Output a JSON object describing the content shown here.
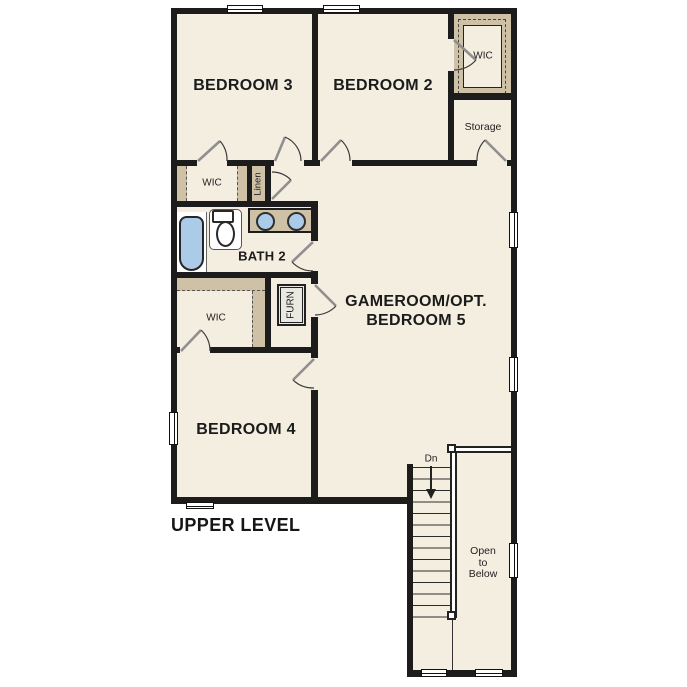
{
  "plan": {
    "title": "UPPER LEVEL",
    "labels": {
      "bedroom3": "BEDROOM 3",
      "bedroom2": "BEDROOM 2",
      "bedroom4": "BEDROOM 4",
      "gameroom_line1": "GAMEROOM/OPT.",
      "gameroom_line2": "BEDROOM 5",
      "bath2": "BATH 2",
      "wic_top_right": "WIC",
      "wic_upper": "WIC",
      "wic_lower": "WIC",
      "storage": "Storage",
      "linen": "Linen",
      "furnace": "FURN",
      "down": "Dn",
      "open_below_1": "Open",
      "open_below_2": "to",
      "open_below_3": "Below"
    },
    "colors": {
      "floor": "#f4eee1",
      "wall": "#1c1c1c",
      "shelf": "#cec1a6",
      "fixture_blue": "#abcbe8",
      "furn_fill": "#e9e9e1"
    }
  }
}
